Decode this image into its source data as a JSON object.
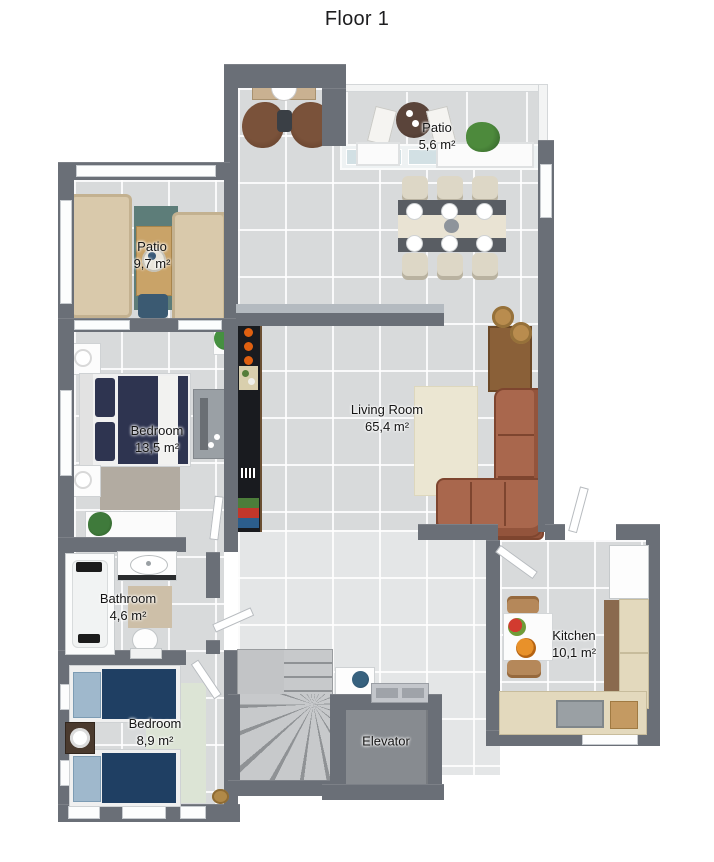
{
  "title": "Floor 1",
  "rooms": {
    "patio_top": {
      "name": "Patio",
      "area": "5,6 m²"
    },
    "patio_left": {
      "name": "Patio",
      "area": "9,7 m²"
    },
    "bedroom_1": {
      "name": "Bedroom",
      "area": "13,5 m²"
    },
    "living_room": {
      "name": "Living Room",
      "area": "65,4 m²"
    },
    "bathroom": {
      "name": "Bathroom",
      "area": "4,6 m²"
    },
    "bedroom_2": {
      "name": "Bedroom",
      "area": "8,9 m²"
    },
    "kitchen": {
      "name": "Kitchen",
      "area": "10,1 m²"
    },
    "elevator": {
      "name": "Elevator"
    }
  },
  "colors": {
    "wall": "#6a6f77",
    "floor_tile": "#d8dadb",
    "sofa_brown": "#a9674d",
    "sofa_beige": "#d9c9ab",
    "bed_navy": "#2e3450",
    "rug_green": "#dce4d5",
    "rug_teal": "#5d7d79",
    "rug_cream": "#ebe6d2",
    "counter_cream": "#e3d9bd",
    "counter_black": "#191b1f",
    "label_text": "#141414"
  }
}
